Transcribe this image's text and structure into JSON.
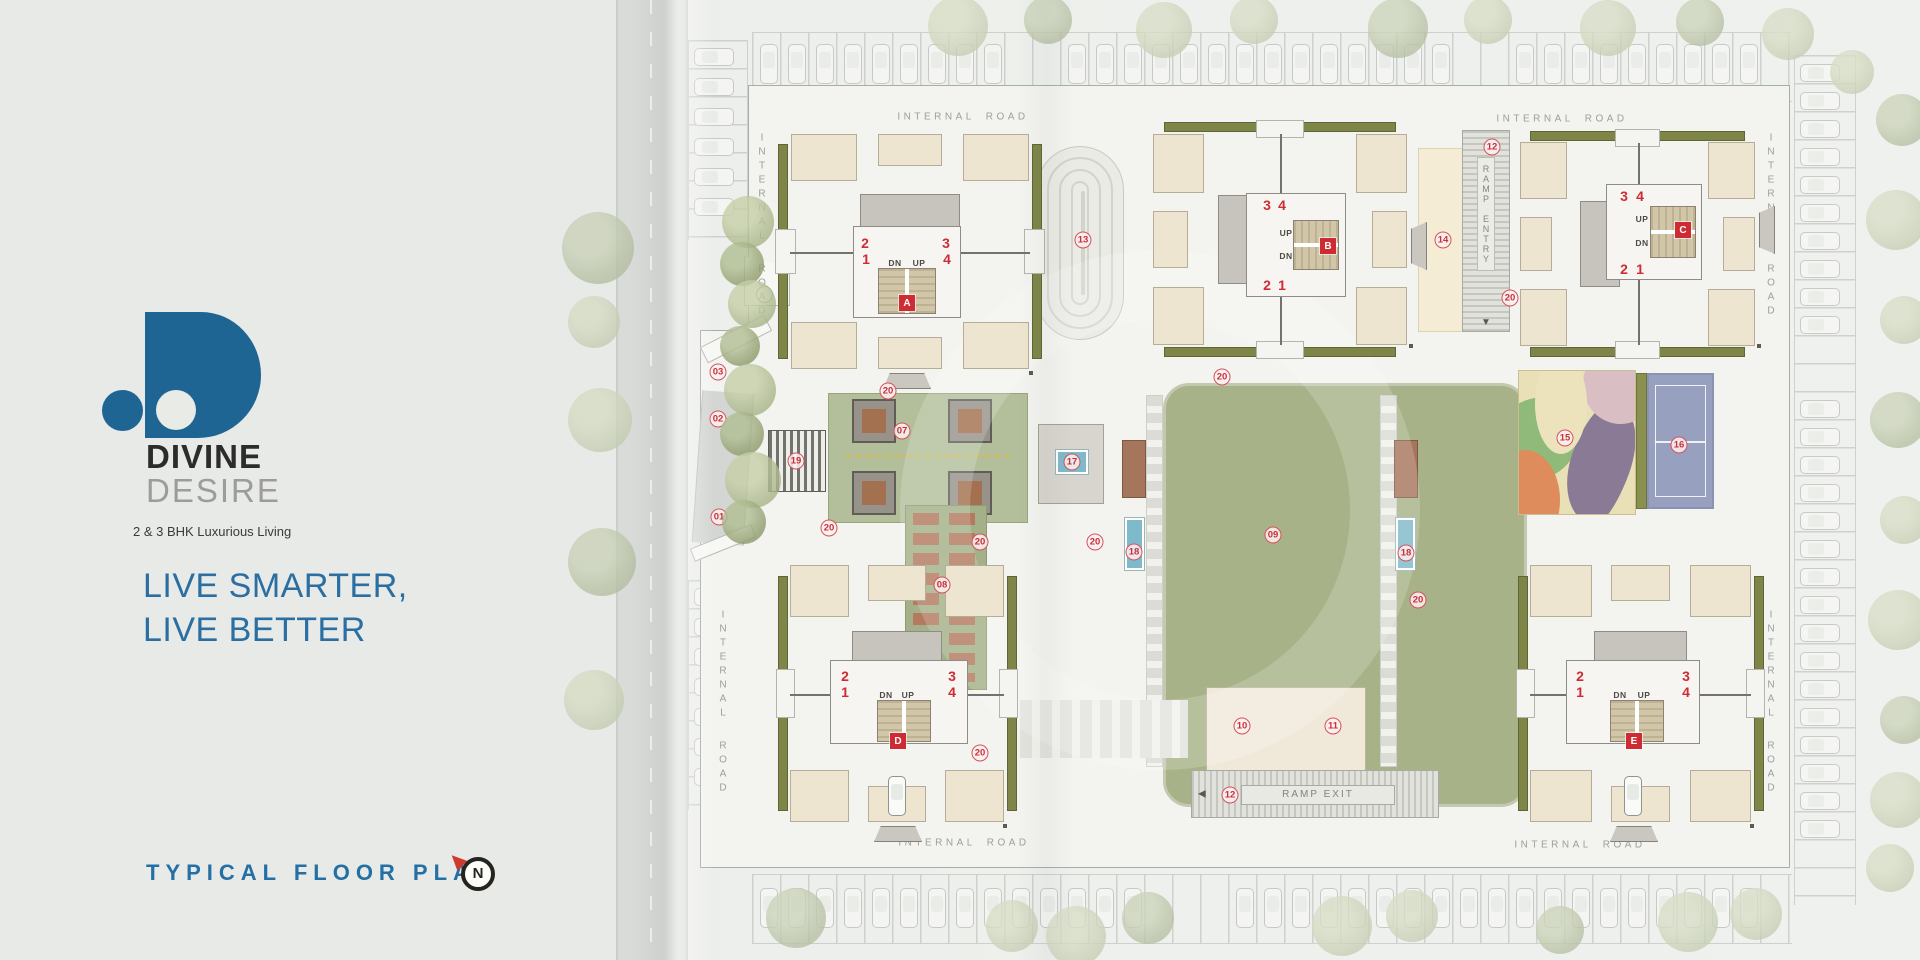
{
  "brand": {
    "line1": "DIVINE",
    "line2": "DESIRE",
    "tagline": "2 & 3 BHK Luxurious Living",
    "headline1": "LIVE SMARTER,",
    "headline2": "LIVE BETTER",
    "plan_title": "TYPICAL FLOOR PLAN",
    "north": "N"
  },
  "colors": {
    "logo_blue": "#1f6594",
    "accent_blue": "#2b6ea2",
    "marker_red": "#c8303c",
    "badge_red": "#cf2b33",
    "olive_green": "#7e8547",
    "lawn_green": "#a8b288",
    "room_beige": "#ede5d0",
    "court_blue": "#98a0c0",
    "pool_blue": "#7fbaca"
  },
  "plan": {
    "road_label": "INTERNAL ROAD",
    "ramp_entry": "RAMP ENTRY",
    "ramp_exit": "RAMP EXIT",
    "up": "UP",
    "dn": "DN",
    "road_labels": [
      {
        "x": 963,
        "y": 117,
        "o": "h"
      },
      {
        "x": 1562,
        "y": 119,
        "o": "h"
      },
      {
        "x": 964,
        "y": 843,
        "o": "h"
      },
      {
        "x": 1580,
        "y": 845,
        "o": "h"
      },
      {
        "x": 762,
        "y": 226,
        "o": "v"
      },
      {
        "x": 723,
        "y": 703,
        "o": "v"
      },
      {
        "x": 1771,
        "y": 226,
        "o": "v"
      },
      {
        "x": 1771,
        "y": 703,
        "o": "v"
      }
    ],
    "buildings": [
      {
        "id": "A",
        "x": 778,
        "y": 126,
        "w": 264,
        "h": 251,
        "orient": "v",
        "lobby": [
          853,
          226,
          108,
          92
        ],
        "stair": [
          878,
          268,
          58,
          46
        ],
        "badge": [
          907,
          303
        ],
        "labels": [
          {
            "t": "2",
            "x": 865,
            "y": 243
          },
          {
            "t": "1",
            "x": 866,
            "y": 259
          },
          {
            "t": "3",
            "x": 946,
            "y": 243
          },
          {
            "t": "4",
            "x": 947,
            "y": 259
          },
          {
            "t": "DN",
            "x": 895,
            "y": 263,
            "s": 1
          },
          {
            "t": "UP",
            "x": 919,
            "y": 263,
            "s": 1
          }
        ]
      },
      {
        "id": "B",
        "x": 1145,
        "y": 122,
        "w": 270,
        "h": 235,
        "orient": "h",
        "lobby": [
          1246,
          193,
          100,
          104
        ],
        "stair": [
          1293,
          220,
          46,
          50
        ],
        "badge": [
          1328,
          246
        ],
        "labels": [
          {
            "t": "3",
            "x": 1267,
            "y": 205
          },
          {
            "t": "4",
            "x": 1282,
            "y": 205
          },
          {
            "t": "2",
            "x": 1267,
            "y": 285
          },
          {
            "t": "1",
            "x": 1282,
            "y": 285
          },
          {
            "t": "UP",
            "x": 1286,
            "y": 233,
            "s": 1
          },
          {
            "t": "DN",
            "x": 1286,
            "y": 256,
            "s": 1
          }
        ]
      },
      {
        "id": "C",
        "x": 1512,
        "y": 131,
        "w": 251,
        "h": 226,
        "orient": "h",
        "lobby": [
          1606,
          184,
          96,
          96
        ],
        "stair": [
          1650,
          206,
          46,
          52
        ],
        "badge": [
          1683,
          230
        ],
        "labels": [
          {
            "t": "3",
            "x": 1624,
            "y": 196
          },
          {
            "t": "4",
            "x": 1640,
            "y": 196
          },
          {
            "t": "2",
            "x": 1624,
            "y": 269
          },
          {
            "t": "1",
            "x": 1640,
            "y": 269
          },
          {
            "t": "UP",
            "x": 1642,
            "y": 219,
            "s": 1
          },
          {
            "t": "DN",
            "x": 1642,
            "y": 243,
            "s": 1
          }
        ]
      },
      {
        "id": "D",
        "x": 778,
        "y": 557,
        "w": 238,
        "h": 273,
        "orient": "v",
        "lobby": [
          830,
          660,
          138,
          84
        ],
        "stair": [
          877,
          700,
          54,
          42
        ],
        "badge": [
          898,
          741
        ],
        "labels": [
          {
            "t": "2",
            "x": 845,
            "y": 676
          },
          {
            "t": "1",
            "x": 845,
            "y": 692
          },
          {
            "t": "3",
            "x": 952,
            "y": 676
          },
          {
            "t": "4",
            "x": 952,
            "y": 692
          },
          {
            "t": "DN",
            "x": 886,
            "y": 695,
            "s": 1
          },
          {
            "t": "UP",
            "x": 908,
            "y": 695,
            "s": 1
          }
        ]
      },
      {
        "id": "E",
        "x": 1518,
        "y": 557,
        "w": 245,
        "h": 273,
        "orient": "v",
        "lobby": [
          1566,
          660,
          134,
          84
        ],
        "stair": [
          1610,
          700,
          54,
          42
        ],
        "badge": [
          1634,
          741
        ],
        "labels": [
          {
            "t": "2",
            "x": 1580,
            "y": 676
          },
          {
            "t": "1",
            "x": 1580,
            "y": 692
          },
          {
            "t": "3",
            "x": 1686,
            "y": 676
          },
          {
            "t": "4",
            "x": 1686,
            "y": 692
          },
          {
            "t": "DN",
            "x": 1620,
            "y": 695,
            "s": 1
          },
          {
            "t": "UP",
            "x": 1644,
            "y": 695,
            "s": 1
          }
        ]
      }
    ],
    "markers": [
      {
        "label": "01",
        "x": 719,
        "y": 517
      },
      {
        "label": "02",
        "x": 718,
        "y": 419
      },
      {
        "label": "03",
        "x": 718,
        "y": 372
      },
      {
        "label": "07",
        "x": 902,
        "y": 431
      },
      {
        "label": "08",
        "x": 942,
        "y": 585
      },
      {
        "label": "09",
        "x": 1273,
        "y": 535
      },
      {
        "label": "10",
        "x": 1242,
        "y": 726
      },
      {
        "label": "11",
        "x": 1333,
        "y": 726
      },
      {
        "label": "12",
        "x": 1492,
        "y": 147
      },
      {
        "label": "12",
        "x": 1230,
        "y": 795
      },
      {
        "label": "13",
        "x": 1083,
        "y": 240
      },
      {
        "label": "14",
        "x": 1443,
        "y": 240
      },
      {
        "label": "15",
        "x": 1565,
        "y": 438
      },
      {
        "label": "16",
        "x": 1679,
        "y": 445
      },
      {
        "label": "17",
        "x": 1072,
        "y": 462
      },
      {
        "label": "18",
        "x": 1134,
        "y": 552
      },
      {
        "label": "18",
        "x": 1406,
        "y": 553
      },
      {
        "label": "19",
        "x": 796,
        "y": 461
      },
      {
        "label": "20",
        "x": 888,
        "y": 391
      },
      {
        "label": "20",
        "x": 829,
        "y": 528
      },
      {
        "label": "20",
        "x": 980,
        "y": 542
      },
      {
        "label": "20",
        "x": 980,
        "y": 753
      },
      {
        "label": "20",
        "x": 1095,
        "y": 542
      },
      {
        "label": "20",
        "x": 1418,
        "y": 600
      },
      {
        "label": "20",
        "x": 1510,
        "y": 298
      },
      {
        "label": "20",
        "x": 1222,
        "y": 377
      }
    ]
  }
}
